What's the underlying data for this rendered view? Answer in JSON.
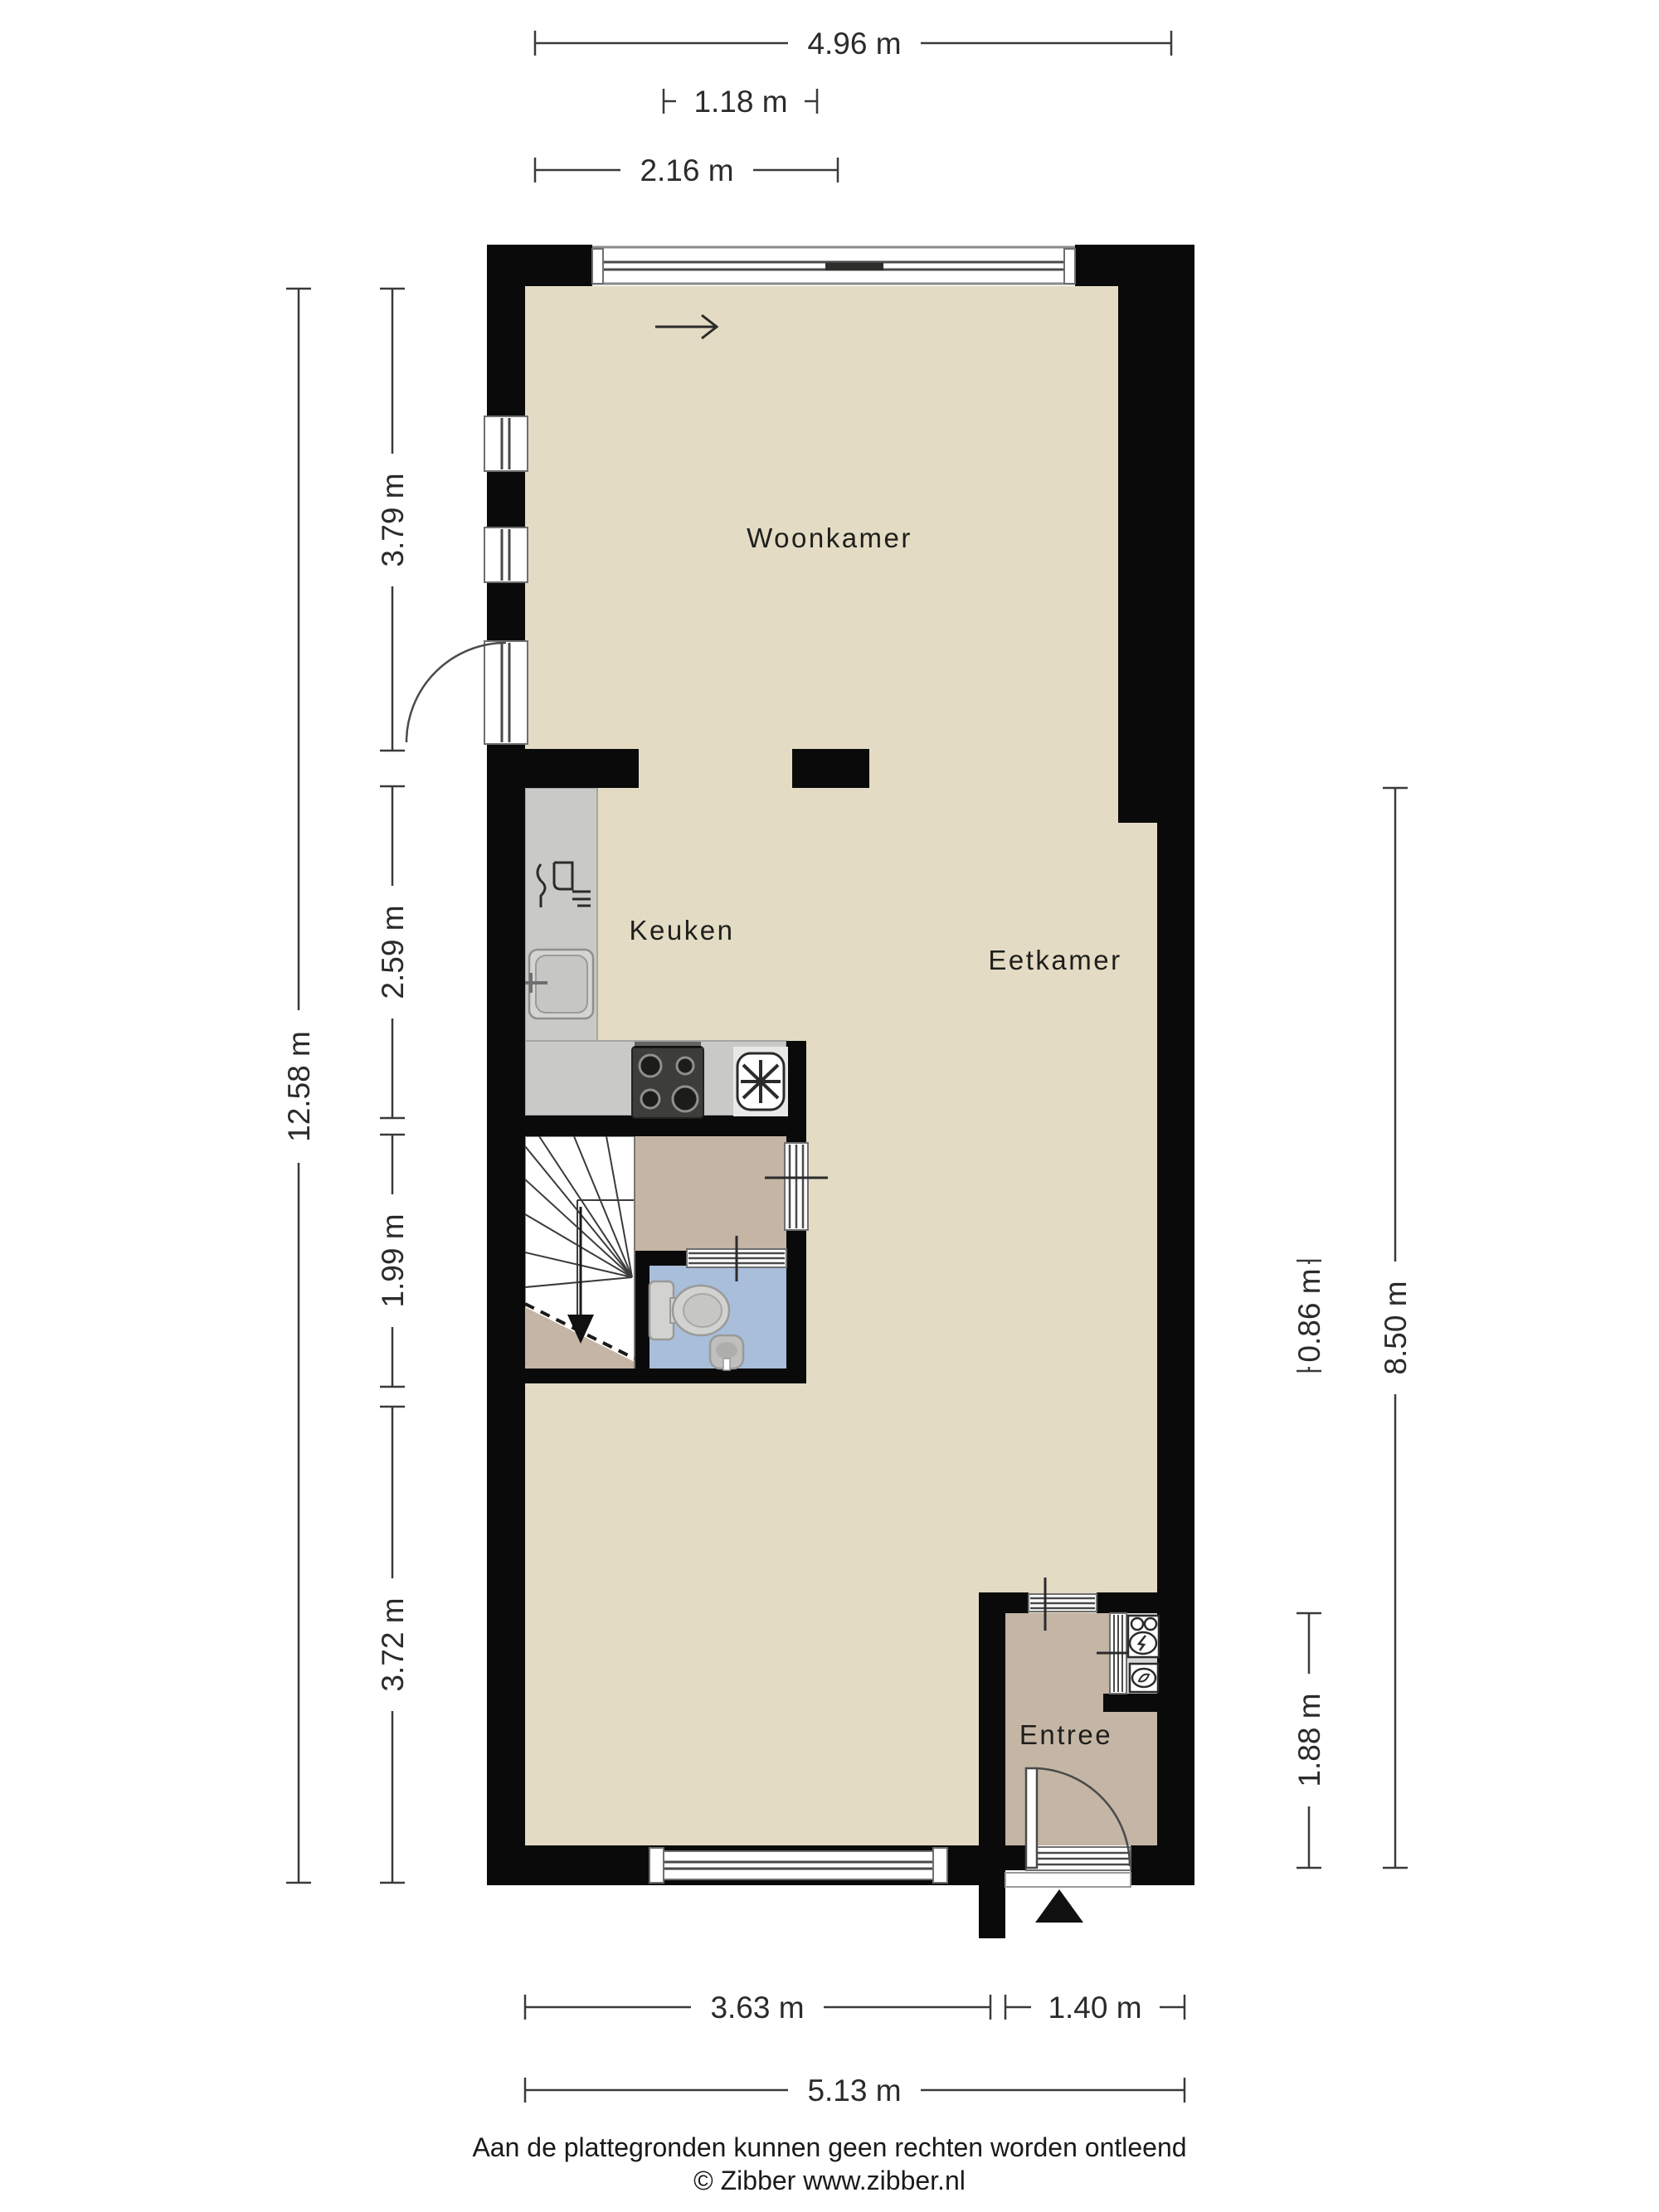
{
  "rooms": {
    "woonkamer": "Woonkamer",
    "keuken": "Keuken",
    "eetkamer": "Eetkamer",
    "entree": "Entree"
  },
  "dimensions": {
    "top_total_width": "4.96 m",
    "top_slider_width": "1.18 m",
    "top_kitchen_width": "2.16 m",
    "left_total_height": "12.58 m",
    "left_woonkamer": "3.79 m",
    "left_keuken": "2.59 m",
    "left_stairs": "1.99 m",
    "left_rear": "3.72 m",
    "right_toilet_depth": "0.86 m",
    "right_entree_depth": "1.88 m",
    "right_total": "8.50 m",
    "bottom_window_section": "3.63 m",
    "bottom_entree_section": "1.40 m",
    "bottom_total": "5.13 m"
  },
  "footer": {
    "disclaimer": "Aan de plattegronden kunnen geen rechten worden ontleend",
    "copyright": "© Zibber www.zibber.nl"
  },
  "colors": {
    "wall": "#0a0a0a",
    "floor_main": "#e3dbc3",
    "floor_hall": "#c4b5a4",
    "floor_toilet": "#a8bedb",
    "floor_meter_cupboard": "#d6d6d4",
    "kitchen_counter": "#c9c9c7",
    "stove": "#3d3d3b",
    "dimension_text": "#2b2b2b"
  },
  "fixtures": [
    "sliding-window",
    "window",
    "door",
    "stairs-down",
    "toilet",
    "hand-basin",
    "kitchen-sink",
    "dishwasher",
    "stove",
    "extractor-fan",
    "electric-meter",
    "gas-meter",
    "entrance-marker"
  ]
}
